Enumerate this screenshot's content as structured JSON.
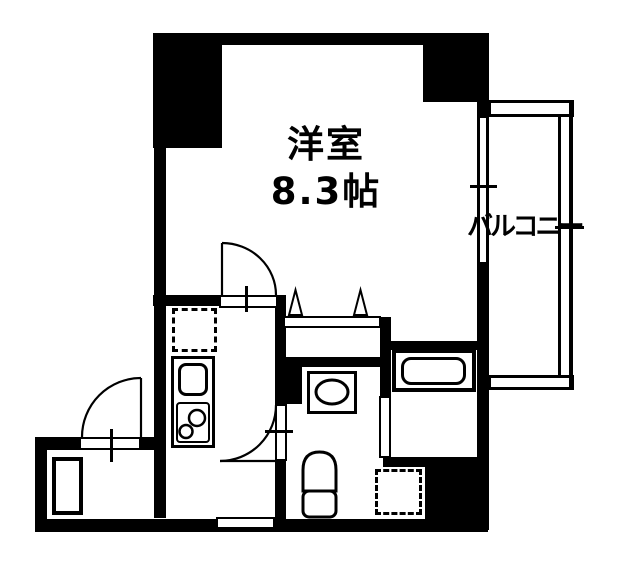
{
  "plan": {
    "type": "apartment-floor-plan",
    "labels": {
      "room": "洋室",
      "room_size": "8.3帖",
      "balcony": "バルコニー"
    },
    "colors": {
      "ink": "#000000",
      "paper": "#ffffff"
    },
    "fixture_icons": [
      "kitchen-sink-icon",
      "gas-stove-icon",
      "refrigerator-space-icon",
      "shoe-cabinet-icon",
      "washbasin-icon",
      "toilet-icon",
      "bathtub-icon",
      "washing-machine-space-icon",
      "closet-folding-door-icon",
      "sliding-window-icon",
      "door-swing-arc-icon"
    ]
  }
}
